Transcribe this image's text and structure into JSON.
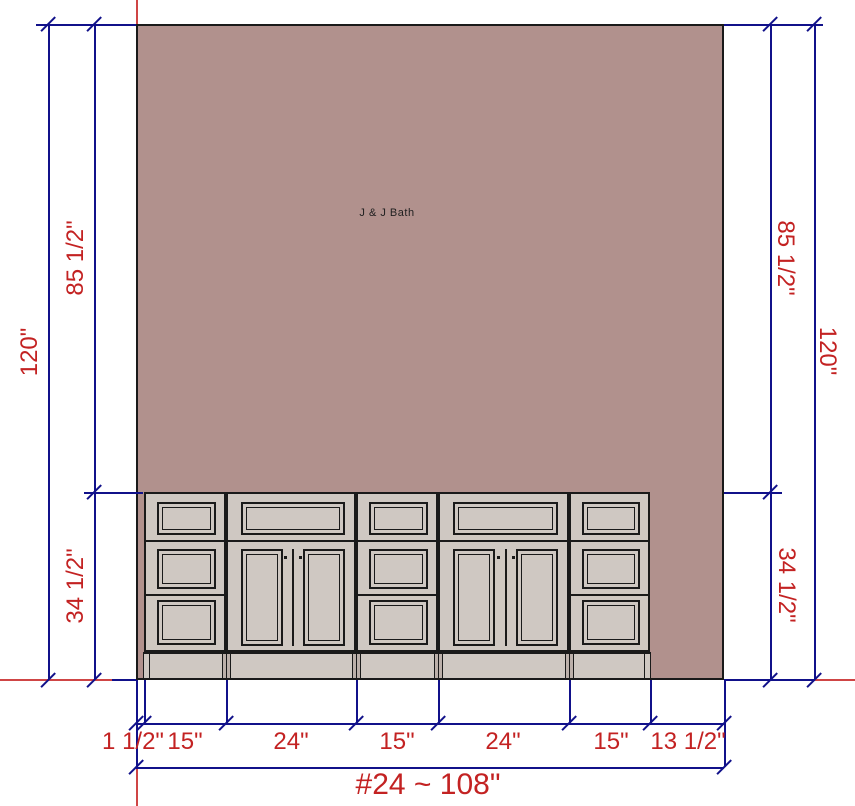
{
  "drawing": {
    "room_label": "J & J Bath",
    "dim_labels": {
      "left": [
        "120\"",
        "85 1/2\"",
        "34 1/2\""
      ],
      "right": [
        "85 1/2\"",
        "120\"",
        "34 1/2\""
      ],
      "bottom": [
        "1 1/2\"",
        "15\"",
        "24\"",
        "15\"",
        "24\"",
        "15\"",
        "13 1/2\""
      ],
      "overall": "#24 ~ 108\""
    },
    "wall": {
      "overall_width_in": 108,
      "overall_height_in": 120,
      "upper_height_in": 85.5,
      "cabinet_height_in": 34.5
    },
    "cabinets": {
      "sections": [
        {
          "type": "drawer-bank",
          "nominal_width": "15\"",
          "drawers": 3
        },
        {
          "type": "door-cabinet",
          "nominal_width": "24\"",
          "doors": 2,
          "top_drawer": true
        },
        {
          "type": "drawer-bank",
          "nominal_width": "15\"",
          "drawers": 3
        },
        {
          "type": "door-cabinet",
          "nominal_width": "24\"",
          "doors": 2,
          "top_drawer": true
        },
        {
          "type": "drawer-bank",
          "nominal_width": "15\"",
          "drawers": 3
        }
      ]
    },
    "colors": {
      "wall": "#b1918d",
      "cabinet": "#cfc8c2",
      "outline": "#1a1a1a",
      "dimension_line": "#11118a",
      "dimension_text": "#c32222",
      "guide_line": "#cf4545"
    }
  }
}
